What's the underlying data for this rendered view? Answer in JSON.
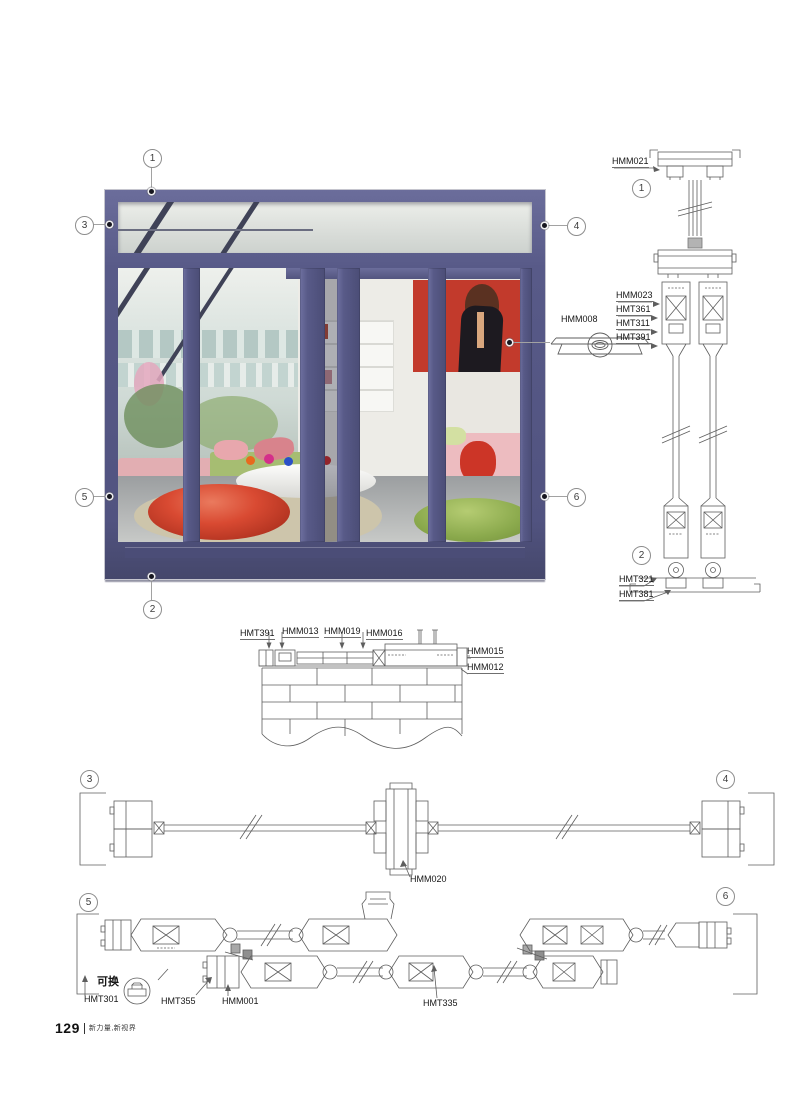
{
  "page": {
    "number": "129",
    "slogan": "新力量,新视界"
  },
  "colors": {
    "frame": "#585a88",
    "accent_red": "#c23a2c",
    "drawing_line": "#5e5e5e"
  },
  "photo": {
    "callout_top": "1",
    "callout_bottom": "2",
    "callout_left_top": "3",
    "callout_right_top": "4",
    "callout_left_mid": "5",
    "callout_right_mid": "6",
    "handle_label": "HMM008"
  },
  "vertical_section": {
    "callout_top": "1",
    "callout_bottom": "2",
    "label_top": "HMM021",
    "labels_mid": [
      "HMM023",
      "HMT361",
      "HMT311",
      "HMT391"
    ],
    "labels_bottom": [
      "HMT321",
      "HMT381"
    ]
  },
  "sill_section": {
    "labels_top": [
      "HMT391",
      "HMM013",
      "HMM019",
      "HMM016"
    ],
    "labels_right": [
      "HMM015",
      "HMM012"
    ]
  },
  "plan_top": {
    "callout_left": "3",
    "callout_right": "4",
    "label_mullion": "HMM020"
  },
  "plan_bottom": {
    "callout_left": "5",
    "callout_right": "6",
    "note": "可换",
    "labels": [
      "HMT301",
      "HMT355",
      "HMM001",
      "HMT335"
    ]
  }
}
